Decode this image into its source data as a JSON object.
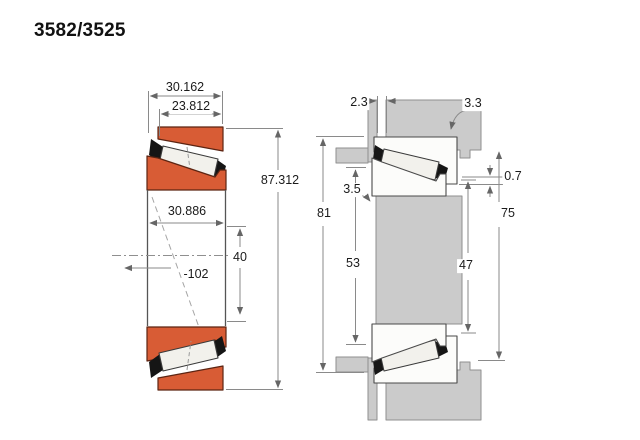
{
  "title": "3582/3525",
  "left_view": {
    "name": "bearing cross-section",
    "dims": {
      "total_width": "30.162",
      "cup_width": "23.812",
      "outer_diameter": "87.312",
      "cone_width": "30.886",
      "bore_ref": "40",
      "offset_ref": "-102"
    }
  },
  "right_view": {
    "name": "mounted arrangement",
    "dims": {
      "spacer_gap": "2.3",
      "housing_fillet": "3.3",
      "shaft_fillet": "3.5",
      "housing_span": "81",
      "shaft_shoulder_span": "53",
      "cup_standout": "0.7",
      "housing_shoulder_span": "75",
      "shaft_abutment_span": "47"
    }
  },
  "colors": {
    "ring_orange": "#D85C35",
    "roller_white": "#F2F1EC",
    "cage_black": "#151515",
    "metal_gray": "#CBCBCB",
    "dim_line": "#8A8A8A",
    "text": "#1B1B1B"
  }
}
